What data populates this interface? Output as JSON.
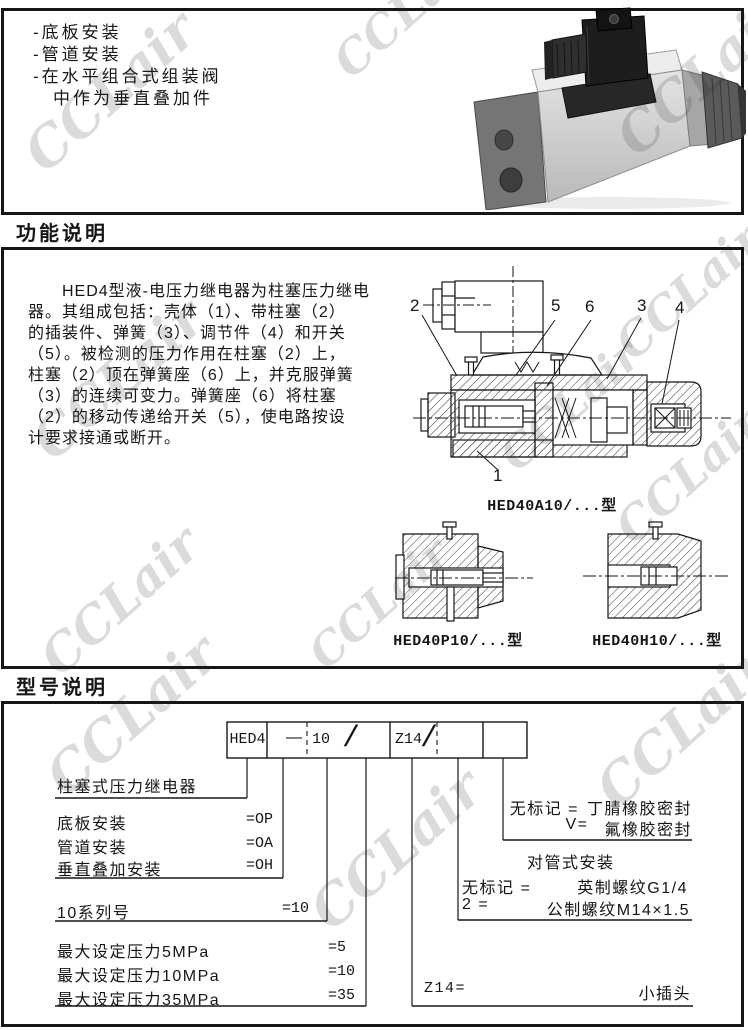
{
  "page": {
    "watermark": "CCLair"
  },
  "intro": {
    "bullets": [
      "-底板安装",
      "-管道安装",
      "-在水平组合式组装阀",
      "　中作为垂直叠加件"
    ]
  },
  "section_function": {
    "title": "功能说明"
  },
  "section_model": {
    "title": "型号说明"
  },
  "function_text": {
    "lines": [
      "　　HED4型液-电压力继电器为柱塞压力继电",
      "器。其组成包括：壳体（1）、带柱塞（2）",
      "的插装件、弹簧（3）、调节件（4）和开关",
      "（5）。被检测的压力作用在柱塞（2）上，",
      "柱塞（2）顶在弹簧座（6）上，并克服弹簧",
      "（3）的连续可变力。弹簧座（6）将柱塞",
      "（2）的移动传递给开关（5），使电路按设",
      "计要求接通或断开。"
    ]
  },
  "figures": {
    "main": {
      "caption": "HED40A10/...型",
      "callouts": {
        "n1": "1",
        "n2": "2",
        "n3": "3",
        "n4": "4",
        "n5": "5",
        "n6": "6"
      }
    },
    "p10": {
      "caption": "HED40P10/...型"
    },
    "h10": {
      "caption": "HED40H10/...型"
    }
  },
  "model_code": {
    "cells": {
      "prefix": "HED4",
      "dash": "—",
      "series": "10",
      "sep1": "/",
      "port": "Z14",
      "sep2": "/"
    },
    "rows_left": [
      {
        "label": "柱塞式压力继电器",
        "value": ""
      },
      {
        "label": "底板安装",
        "value": "=OP"
      },
      {
        "label": "管道安装",
        "value": "=OA"
      },
      {
        "label": "垂直叠加安装",
        "value": "=OH"
      },
      {
        "label": "10系列号",
        "value": "=10"
      },
      {
        "label": "最大设定压力5MPa",
        "value": "=5"
      },
      {
        "label": "最大设定压力10MPa",
        "value": "=10"
      },
      {
        "label": "最大设定压力35MPa",
        "value": "=35"
      }
    ],
    "seal": {
      "k1": "无标记 =",
      "v1": "丁腈橡胶密封",
      "k2": "V=",
      "v2": "氟橡胶密封"
    },
    "pipe": {
      "title": "对管式安装",
      "k1": "无标记 =",
      "v1": "英制螺纹G1/4",
      "k2": "2 =",
      "v2": "公制螺纹M14×1.5"
    },
    "plug": {
      "key": "Z14=",
      "value": "小插头"
    }
  }
}
